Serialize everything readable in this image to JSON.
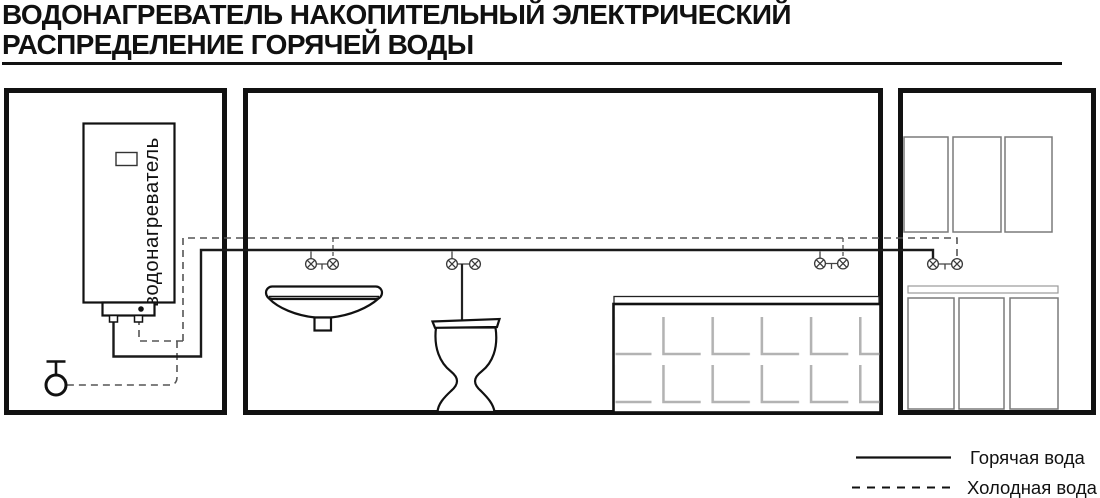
{
  "title": {
    "line1": "ВОДОНАГРЕВАТЕЛЬ НАКОПИТЕЛЬНЫЙ ЭЛЕКТРИЧЕСКИЙ",
    "line2": "РАСПРЕДЕЛЕНИЕ ГОРЯЧЕЙ ВОДЫ"
  },
  "heater": {
    "label": "водонагреватель"
  },
  "legend": {
    "hot": {
      "label": "Горячая вода",
      "line_style": "solid"
    },
    "cold": {
      "label": "Холодная вода",
      "line_style": "dashed"
    }
  },
  "colors": {
    "hot_water": "#1a1a1a",
    "cold_water": "#555555",
    "walls": "#111111",
    "tile_pattern": "#b3b3b3",
    "furniture": "#7a7a7a"
  }
}
